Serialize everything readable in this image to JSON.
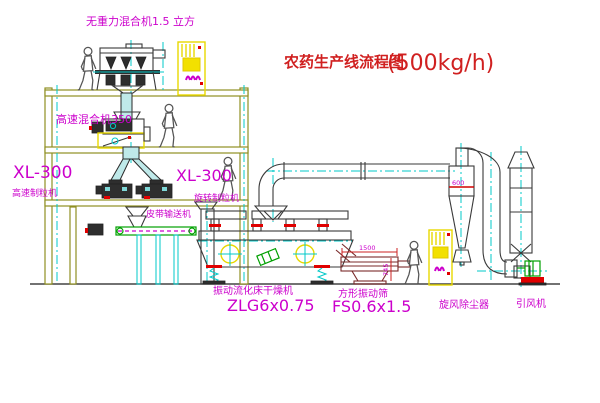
{
  "title": {
    "text": "农药生产线流程图",
    "capacity": "(500kg/h)"
  },
  "labels": {
    "top_mixer": "无重力混合机1.5 立方",
    "floor_mixer": "高速混合机350",
    "granulator_left_model": "XL-300",
    "granulator_left_name": "高速制粒机",
    "granulator_right_model": "XL-300",
    "granulator_right_name": "旋转制粒机",
    "belt_conveyor": "皮带输送机",
    "dryer_name": "振动流化床干燥机",
    "dryer_model": "ZLG6x0.75",
    "sieve_name": "方形振动筛",
    "sieve_model": "FS0.6x1.5",
    "cyclone_name": "旋风除尘器",
    "fan_name": "引风机"
  },
  "dimensions": {
    "cyclone_level": "600",
    "sieve_length": "1500",
    "sieve_height": "745"
  },
  "colors": {
    "background": "#ffffff",
    "building_frame": "#8f8f22",
    "equipment_line": "#3a3a3a",
    "centerline_cyan": "#00c8c8",
    "label_magenta": "#cc00cc",
    "title_red": "#d02020",
    "accent_red": "#e00000",
    "conveyor_green": "#00a000",
    "cabinet_yellow": "#f2e000"
  }
}
